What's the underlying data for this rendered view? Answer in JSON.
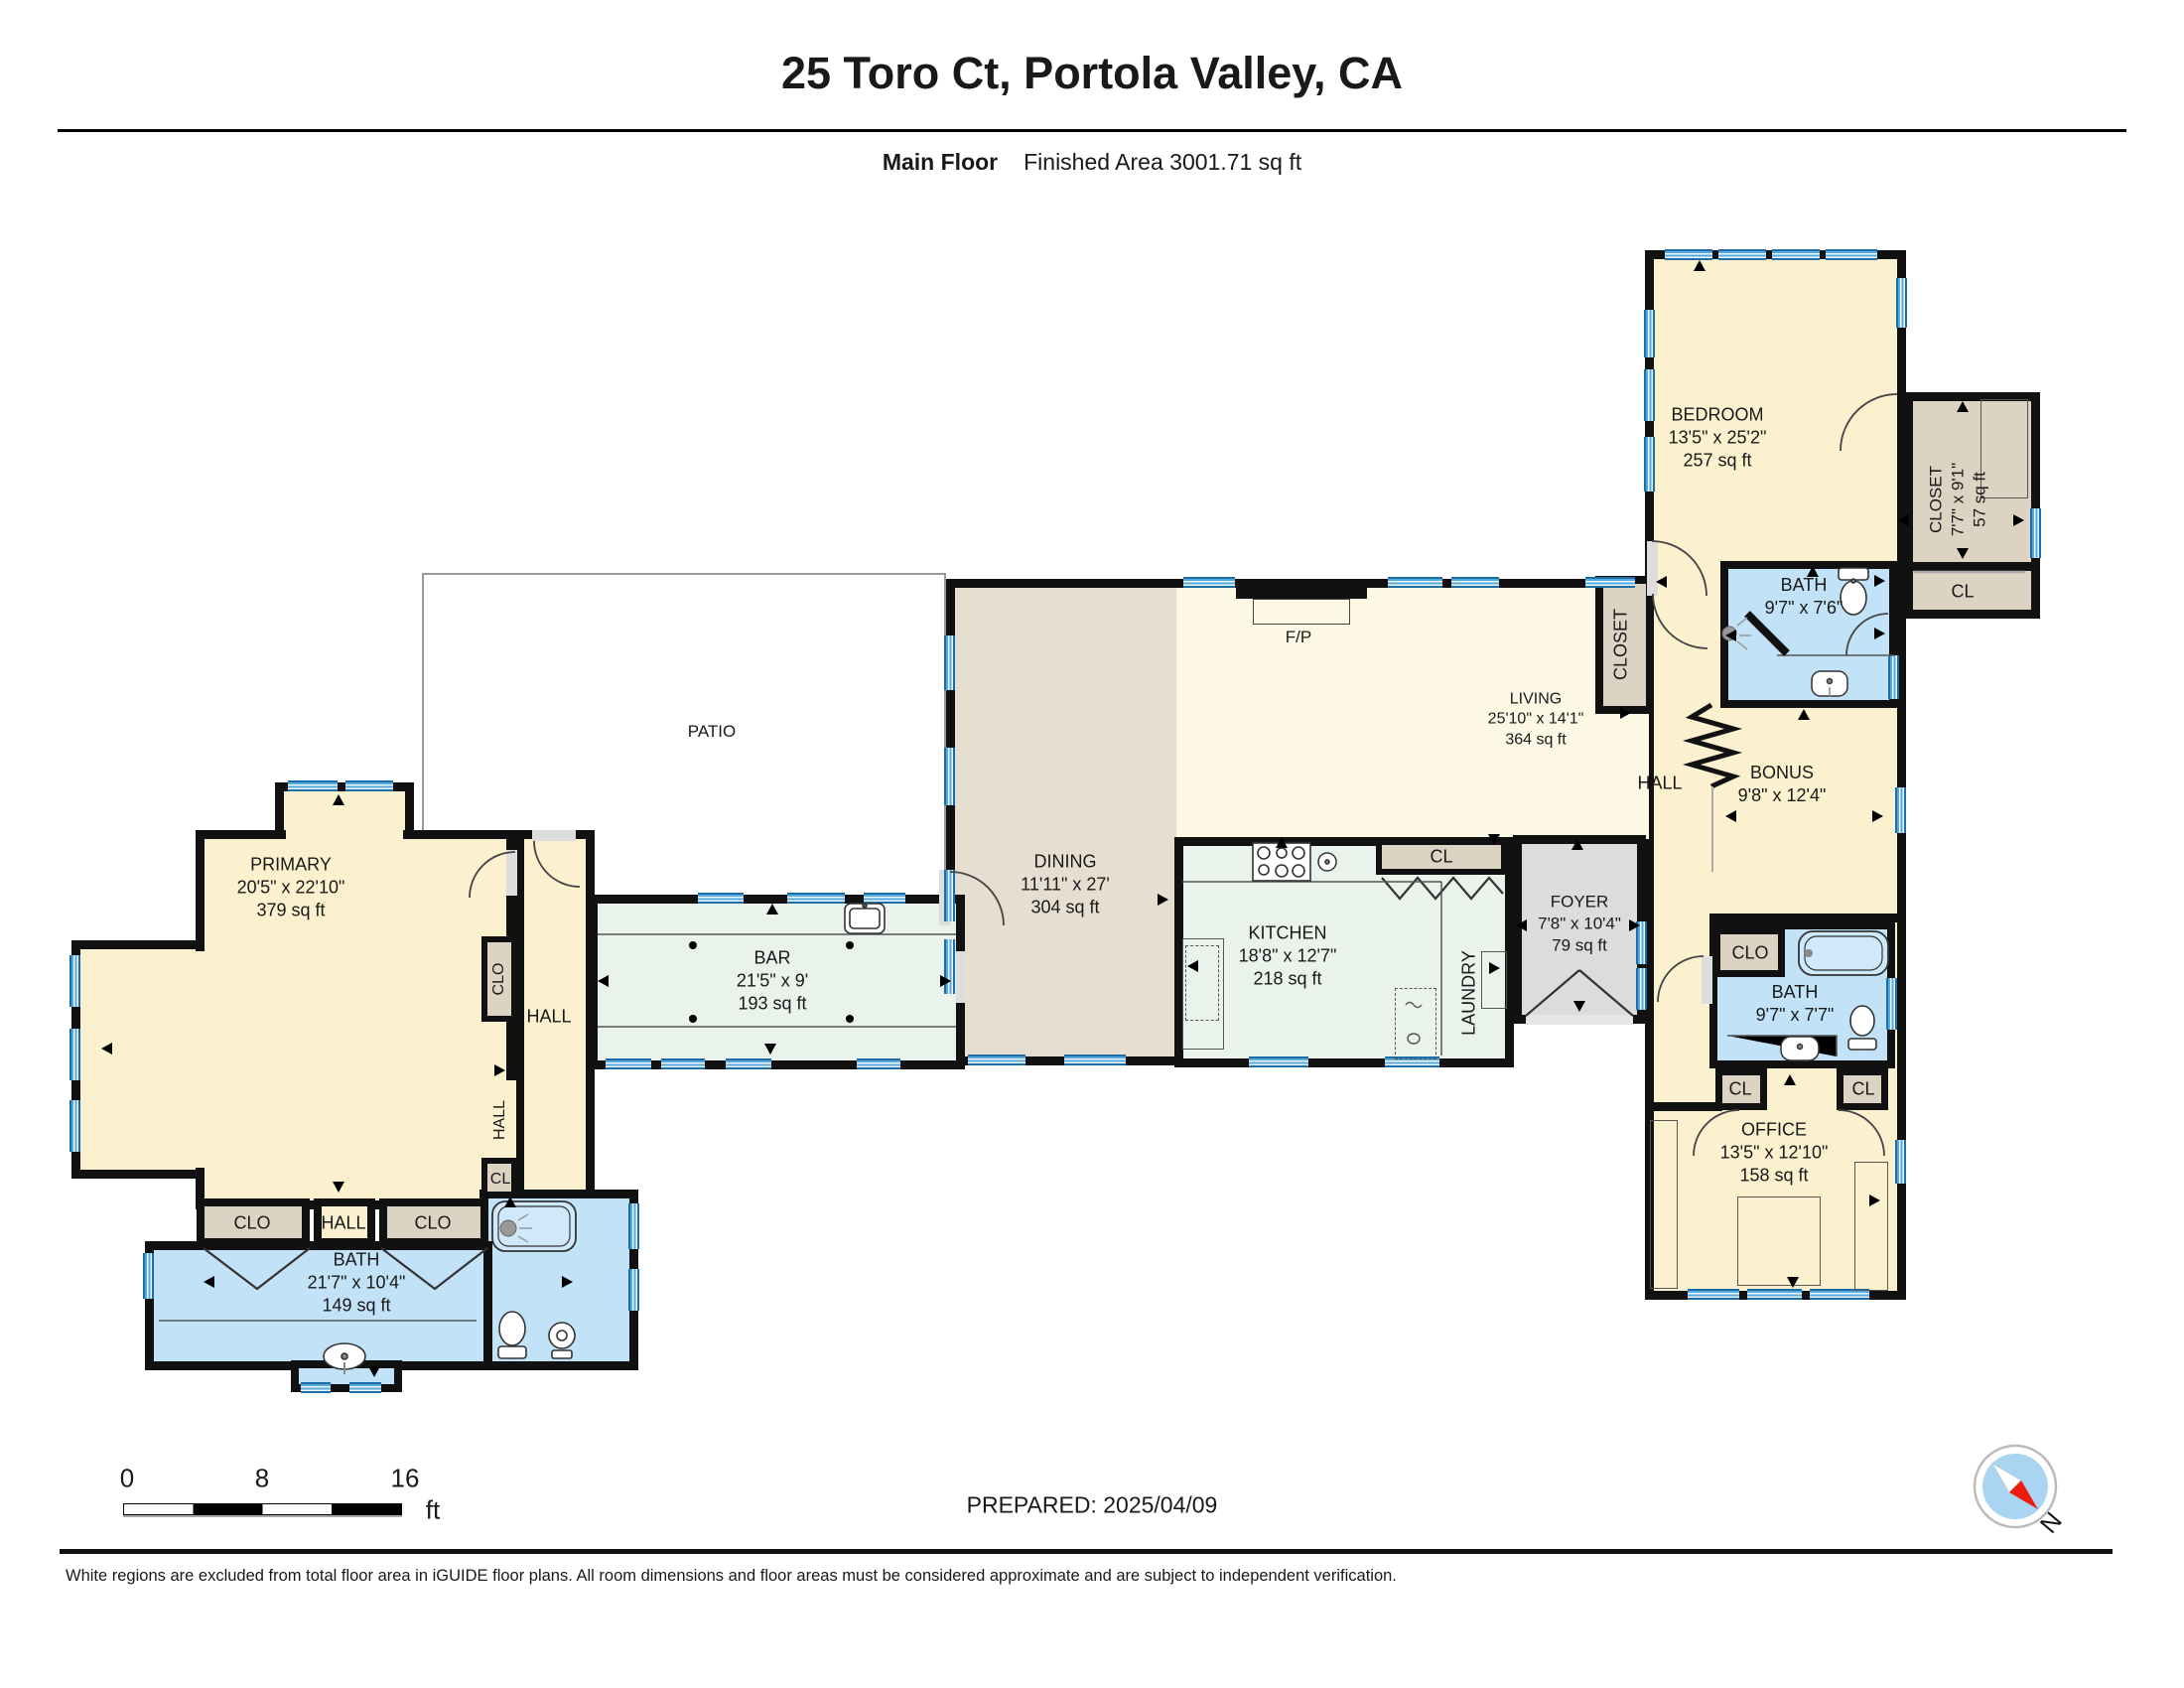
{
  "header": {
    "title": "25 Toro Ct, Portola Valley, CA",
    "floor_label": "Main Floor",
    "area_label": "Finished Area 3001.71 sq ft"
  },
  "rooms": {
    "bedroom": {
      "name": "BEDROOM",
      "dims": "13'5\" x 25'2\"",
      "area": "257 sq ft"
    },
    "bedroom_closet": {
      "name": "CLOSET",
      "dims": "7'7\" x 9'1\"",
      "area": "57 sq ft"
    },
    "bedroom_cl": {
      "name": "CL"
    },
    "bath_top": {
      "name": "BATH",
      "dims": "9'7\" x 7'6\""
    },
    "living_closet": {
      "name": "CLOSET"
    },
    "hall_right": {
      "name": "HALL"
    },
    "bonus": {
      "name": "BONUS",
      "dims": "9'8\" x 12'4\""
    },
    "living": {
      "name": "LIVING",
      "dims": "25'10\" x 14'1\"",
      "area": "364 sq ft"
    },
    "fireplace": {
      "name": "F/P"
    },
    "patio": {
      "name": "PATIO"
    },
    "dining": {
      "name": "DINING",
      "dims": "11'11\" x 27'",
      "area": "304 sq ft"
    },
    "kitchen": {
      "name": "KITCHEN",
      "dims": "18'8\" x 12'7\"",
      "area": "218 sq ft"
    },
    "kitchen_cl": {
      "name": "CL"
    },
    "foyer": {
      "name": "FOYER",
      "dims": "7'8\" x 10'4\"",
      "area": "79 sq ft"
    },
    "laundry": {
      "name": "LAUNDRY"
    },
    "primary": {
      "name": "PRIMARY",
      "dims": "20'5\" x 22'10\"",
      "area": "379 sq ft"
    },
    "primary_clo": {
      "name": "CLO"
    },
    "hall_left": {
      "name": "HALL"
    },
    "bar": {
      "name": "BAR",
      "dims": "21'5\" x 9'",
      "area": "193 sq ft"
    },
    "hall_vertical": {
      "name": "HALL"
    },
    "cl_left": {
      "name": "CL"
    },
    "bath_primary_clo1": {
      "name": "CLO"
    },
    "bath_primary_hall": {
      "name": "HALL"
    },
    "bath_primary_clo2": {
      "name": "CLO"
    },
    "bath_primary": {
      "name": "BATH",
      "dims": "21'7\" x 10'4\"",
      "area": "149 sq ft"
    },
    "office_clo": {
      "name": "CLO"
    },
    "bath_office": {
      "name": "BATH",
      "dims": "9'7\" x 7'7\""
    },
    "office_cl1": {
      "name": "CL"
    },
    "office_cl2": {
      "name": "CL"
    },
    "office": {
      "name": "OFFICE",
      "dims": "13'5\" x 12'10\"",
      "area": "158 sq ft"
    }
  },
  "scale_bar": {
    "tick_0": "0",
    "tick_8": "8",
    "tick_16": "16",
    "unit": "ft"
  },
  "prepared_label": "PREPARED: 2025/04/09",
  "compass": {
    "north_label": "N"
  },
  "disclaimer": "White regions are excluded from total floor area in iGUIDE floor plans. All room dimensions and floor areas must be considered approximate and are subject to independent verification.",
  "colors": {
    "room_cream": "#FBF1CF",
    "room_cream_light": "#FDF8E4",
    "closet_tan": "#DDD3C3",
    "dining_tan": "#E6DED1",
    "kitchen_mint": "#E9F2EB",
    "bath_blue": "#C2E2F8",
    "foyer_gray": "#DCDCDC",
    "wall_black": "#111111",
    "window_blue": "#4D9FD6",
    "compass_red": "#EE1C0C",
    "compass_blue": "#A9D5F2"
  }
}
